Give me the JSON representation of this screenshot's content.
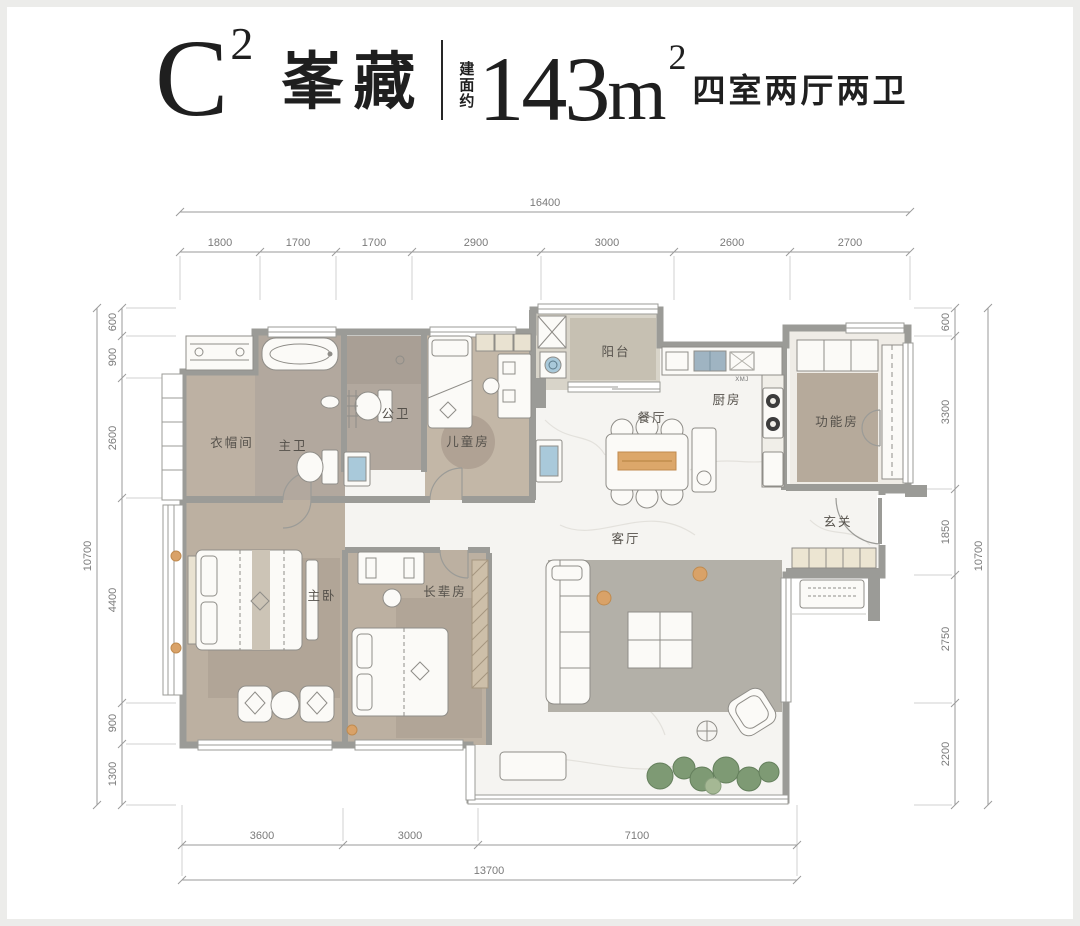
{
  "header": {
    "unit_letter": "C",
    "unit_sup": "2",
    "unit_name": "峯藏",
    "area_prefix": "建面约",
    "area_number": "143",
    "area_unit": "m",
    "area_sup": "2",
    "layout_desc": "四室两厅两卫"
  },
  "dimensions": {
    "top": {
      "total": "16400",
      "segments": [
        "1800",
        "1700",
        "1700",
        "2900",
        "3000",
        "2600",
        "2700"
      ]
    },
    "left": {
      "total": "10700",
      "segments": [
        "600",
        "900",
        "2600",
        "4400",
        "900",
        "1300"
      ]
    },
    "right": {
      "total": "10700",
      "segments": [
        "600",
        "3300",
        "1850",
        "2750",
        "2200"
      ]
    },
    "bottom": {
      "total": "13700",
      "segments": [
        "3600",
        "3000",
        "7100"
      ]
    }
  },
  "rooms": {
    "cloakroom": "衣帽间",
    "master_bath": "主卫",
    "guest_bath": "公卫",
    "children_room": "儿童房",
    "balcony": "阳台",
    "dining": "餐厅",
    "kitchen": "厨房",
    "function_room": "功能房",
    "entry": "玄关",
    "living": "客厅",
    "master_bedroom": "主卧",
    "elder_room": "长辈房"
  },
  "labels": {
    "appliance": "XMJ"
  },
  "colors": {
    "wall": "#9b9b97",
    "wood_floor": "#bdb1a2",
    "bath_floor": "#b2a89e",
    "rug": "#b3b0a8",
    "marble": "#f5f4f1",
    "accent_orange": "#d9a268",
    "accent_blue": "#a9c9da",
    "plant_green": "#7e9a74",
    "dim_text": "#7a7a7a",
    "header_text": "#1f1f1f"
  }
}
